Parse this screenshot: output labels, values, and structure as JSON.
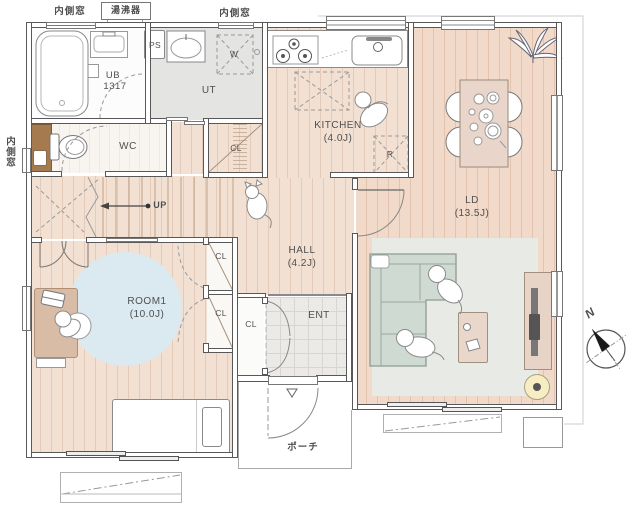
{
  "labels": {
    "inner_window_top_left": "内側窓",
    "water_heater": "湯沸器",
    "inner_window_top_mid": "内側窓",
    "inner_window_left": "内側窓",
    "ps": "PS",
    "ut": "UT",
    "washer": "W",
    "ub": "UB",
    "ub_size": "1317",
    "wc": "WC",
    "kitchen": "KITCHEN",
    "kitchen_size": "(4.0J)",
    "fridge": "R",
    "cl": "CL",
    "up": "UP",
    "hall": "HALL",
    "hall_size": "(4.2J)",
    "ent": "ENT",
    "room1": "ROOM1",
    "room1_size": "(10.0J)",
    "ld": "LD",
    "ld_size": "(13.5J)",
    "porch": "ポーチ",
    "north": "N"
  },
  "colors": {
    "wood_floor": "#f2e1d3",
    "wood_floor_ld": "#f1dac9",
    "wood_stripe": "#e4cbb9",
    "ut_gray": "#e4e4e2",
    "tile_gray": "#eceae7",
    "rug_blue": "#dbe9f0",
    "rug_gray": "#e8eae6",
    "sofa_green": "#cfdad2",
    "furniture_tan": "#e9d5c9",
    "cabinet_brown": "#a57a4e",
    "lamp_yellow": "#f7edc2",
    "wall_gray": "#585858",
    "text_gray": "#4f4f4f"
  }
}
